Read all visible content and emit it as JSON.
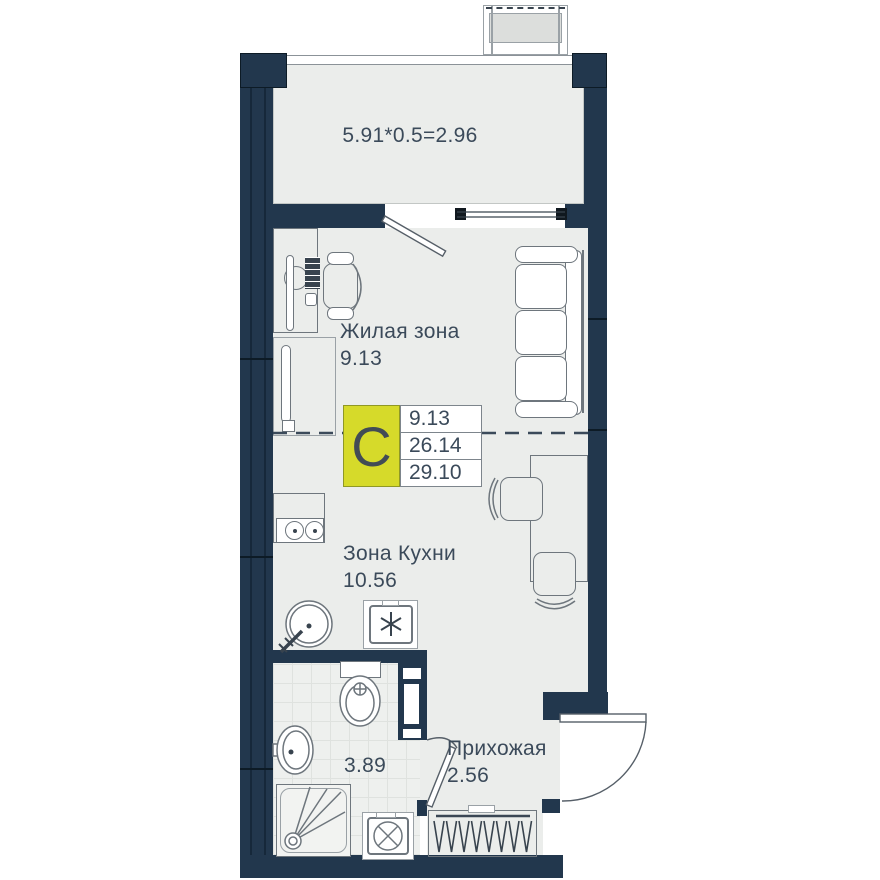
{
  "plan": {
    "title": "studio-apartment-floor-plan",
    "type_badge": {
      "letter": "С",
      "rows": [
        "9.13",
        "26.14",
        "29.10"
      ]
    },
    "rooms": {
      "balcony": {
        "label": "5.91*0.5=2.96"
      },
      "living": {
        "name": "Жилая зона",
        "area": "9.13"
      },
      "kitchen": {
        "name": "Зона Кухни",
        "area": "10.56"
      },
      "bathroom": {
        "area": "3.89"
      },
      "hallway": {
        "name": "Прихожая",
        "area": "2.56"
      }
    },
    "colors": {
      "wall": "#22374d",
      "floor": "#ebedeb",
      "yellow": "#d6da2a",
      "text": "#3b4a5a",
      "line": "#6e767d",
      "panel": "#dcdedc"
    }
  }
}
